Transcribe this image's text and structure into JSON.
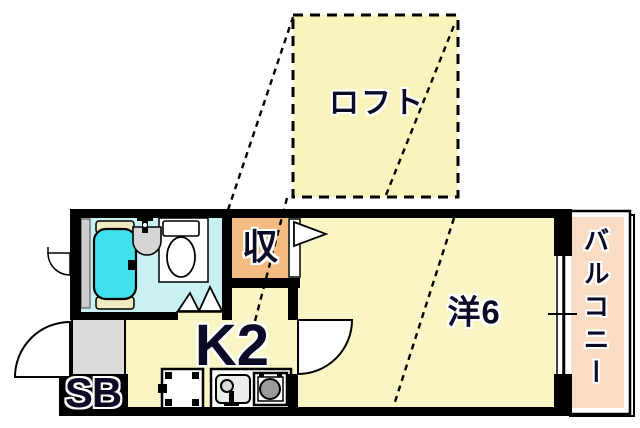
{
  "floor_plan": {
    "rooms": {
      "loft": "ロフト",
      "closet": "収",
      "western_room": "洋6",
      "kitchen": "K2",
      "shoe_box": "SB",
      "balcony": "バルコニー"
    },
    "colors": {
      "floor_yellow": "#FAF5C4",
      "loft_yellow": "#FAF4BC",
      "closet_orange": "#F4BC80",
      "balcony_pink": "#F8DCC4",
      "bath_floor_cyan": "#C9F0F2",
      "bathtub_cyan": "#41E0EA",
      "tub_trim_cream": "#EFEAC0",
      "entrance_gray": "#DBDBDB",
      "pipe_space_gray": "#CDCDCD",
      "wall_black": "#000000",
      "label_ink": "#0B0B26"
    }
  }
}
